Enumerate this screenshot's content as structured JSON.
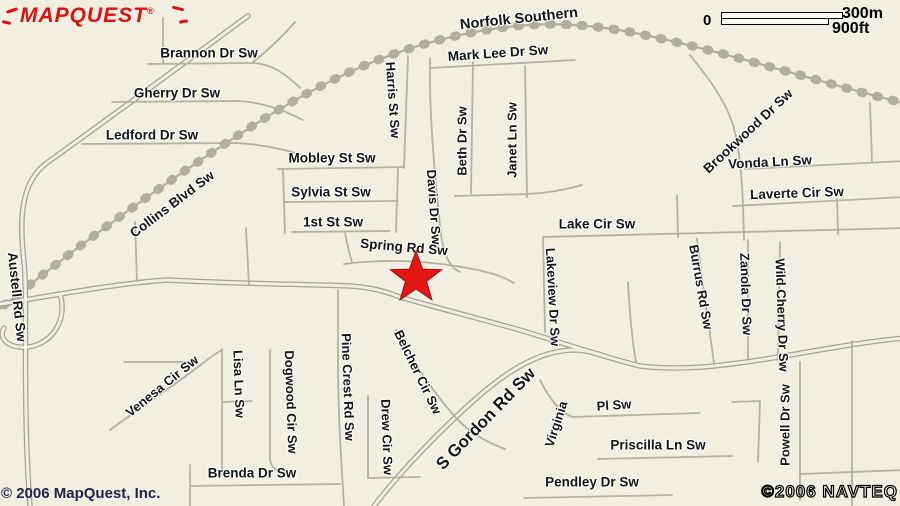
{
  "map": {
    "background_color": "#f1efe1",
    "label_color": "#141414",
    "marker": {
      "icon": "location-star",
      "color": "#e31616",
      "x": 416,
      "y": 278
    },
    "railroad_name": "Norfolk Southern",
    "labels": [
      {
        "t": "Norfolk Southern",
        "x": 519,
        "y": 19,
        "r": -6,
        "s": 14.5
      },
      {
        "t": "Brannon Dr Sw",
        "x": 209,
        "y": 53,
        "r": 0,
        "s": 13.5
      },
      {
        "t": "Mark Lee Dr Sw",
        "x": 498,
        "y": 53,
        "r": -4,
        "s": 13.5
      },
      {
        "t": "Gherry Dr Sw",
        "x": 177,
        "y": 93,
        "r": 0,
        "s": 13.5
      },
      {
        "t": "Ledford Dr Sw",
        "x": 152,
        "y": 135,
        "r": 0,
        "s": 13.5
      },
      {
        "t": "Harris St Sw",
        "x": 393,
        "y": 100,
        "r": 86,
        "s": 13
      },
      {
        "t": "Beth Dr Sw",
        "x": 462,
        "y": 141,
        "r": -90,
        "s": 13
      },
      {
        "t": "Janet Ln Sw",
        "x": 512,
        "y": 140,
        "r": -90,
        "s": 13
      },
      {
        "t": "Mobley St Sw",
        "x": 332,
        "y": 158,
        "r": 0,
        "s": 13.5
      },
      {
        "t": "Sylvia St Sw",
        "x": 331,
        "y": 192,
        "r": 0,
        "s": 13.5
      },
      {
        "t": "1st St Sw",
        "x": 333,
        "y": 222,
        "r": 0,
        "s": 13.5
      },
      {
        "t": "Davis Dr Sw",
        "x": 434,
        "y": 207,
        "r": 86,
        "s": 13
      },
      {
        "t": "Spring Rd Sw",
        "x": 404,
        "y": 247,
        "r": 5,
        "s": 13.5
      },
      {
        "t": "Lake Cir Sw",
        "x": 597,
        "y": 224,
        "r": 0,
        "s": 13.5
      },
      {
        "t": "Collins Blvd Sw",
        "x": 172,
        "y": 204,
        "r": -37,
        "s": 13.5
      },
      {
        "t": "Austell Rd Sw",
        "x": 17,
        "y": 297,
        "r": 84,
        "s": 13.5
      },
      {
        "t": "Brookwood Dr Sw",
        "x": 748,
        "y": 131,
        "r": -43,
        "s": 13.5
      },
      {
        "t": "Vonda Ln Sw",
        "x": 770,
        "y": 162,
        "r": -3,
        "s": 13.5
      },
      {
        "t": "Laverte Cir Sw",
        "x": 797,
        "y": 193,
        "r": -2,
        "s": 13.5
      },
      {
        "t": "Lakeview Dr Sw",
        "x": 553,
        "y": 297,
        "r": 87,
        "s": 13
      },
      {
        "t": "Burrus Rd Sw",
        "x": 701,
        "y": 287,
        "r": 80,
        "s": 13
      },
      {
        "t": "Zanola Dr Sw",
        "x": 746,
        "y": 294,
        "r": 88,
        "s": 13
      },
      {
        "t": "Wild Cherry Dr Sw",
        "x": 782,
        "y": 315,
        "r": 88,
        "s": 13
      },
      {
        "t": "Powell Dr Sw",
        "x": 785,
        "y": 425,
        "r": -90,
        "s": 13
      },
      {
        "t": "Venesa Cir Sw",
        "x": 162,
        "y": 386,
        "r": -39,
        "s": 13
      },
      {
        "t": "Lisa Ln Sw",
        "x": 239,
        "y": 384,
        "r": 88,
        "s": 13
      },
      {
        "t": "Dogwood Cir Sw",
        "x": 291,
        "y": 402,
        "r": 88,
        "s": 13
      },
      {
        "t": "Pine Crest Rd Sw",
        "x": 348,
        "y": 387,
        "r": 88,
        "s": 13
      },
      {
        "t": "Drew Cir Sw",
        "x": 387,
        "y": 437,
        "r": 88,
        "s": 13
      },
      {
        "t": "Belcher Cir Sw",
        "x": 418,
        "y": 372,
        "r": 64,
        "s": 13
      },
      {
        "t": "S Gordon Rd Sw",
        "x": 486,
        "y": 419,
        "r": -46,
        "s": 17
      },
      {
        "t": "Virginia",
        "x": 556,
        "y": 424,
        "r": -72,
        "s": 13
      },
      {
        "t": "Pl Sw",
        "x": 614,
        "y": 405,
        "r": -4,
        "s": 13
      },
      {
        "t": "Priscilla Ln Sw",
        "x": 658,
        "y": 445,
        "r": 0,
        "s": 13.5
      },
      {
        "t": "Brenda Dr Sw",
        "x": 252,
        "y": 473,
        "r": 0,
        "s": 13.5
      },
      {
        "t": "Pendley Dr Sw",
        "x": 592,
        "y": 482,
        "r": 0,
        "s": 13.5
      }
    ]
  },
  "logo": {
    "text": "MAPQUEST",
    "registered": "®",
    "color": "#df1010"
  },
  "scale": {
    "zero": "0",
    "metric": "300m",
    "imperial": "900ft"
  },
  "copyright_left": "© 2006 MapQuest, Inc.",
  "copyright_right": "©2006 NAVTEQ"
}
